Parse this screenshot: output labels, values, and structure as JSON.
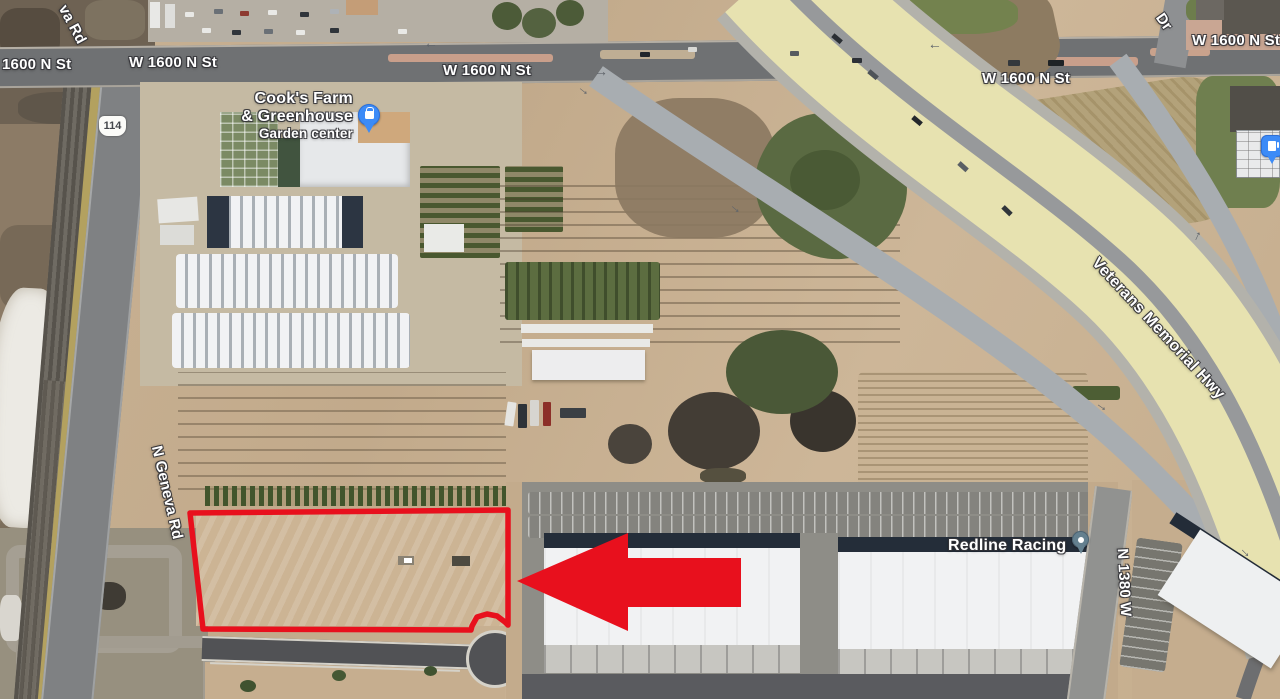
{
  "map": {
    "annotation_color": "#e8101d",
    "roads": {
      "w1600_left": "1600 N St",
      "w1600_mid_left": "W 1600 N St",
      "w1600_center": "W 1600 N St",
      "w1600_right_inner": "W 1600 N St",
      "w1600_right_edge": "W 1600 N St",
      "geneva_partial": "va Rd",
      "geneva": "N Geneva Rd",
      "dr_partial": "Dr",
      "veterans": "Veterans Memorial Hwy",
      "n1380w": "N 1380 W",
      "shield_114": "114"
    },
    "places": {
      "cooks_line1": "Cook's Farm",
      "cooks_line2": "& Greenhouse",
      "cooks_line3": "Garden center",
      "redline": "Redline Racing"
    },
    "icons": {
      "arrow_glyph": "→",
      "shopping_pin_color": "#3c8bf7",
      "gas_pin_color": "#3c8bf7",
      "place_pin_color": "#64808f"
    }
  }
}
